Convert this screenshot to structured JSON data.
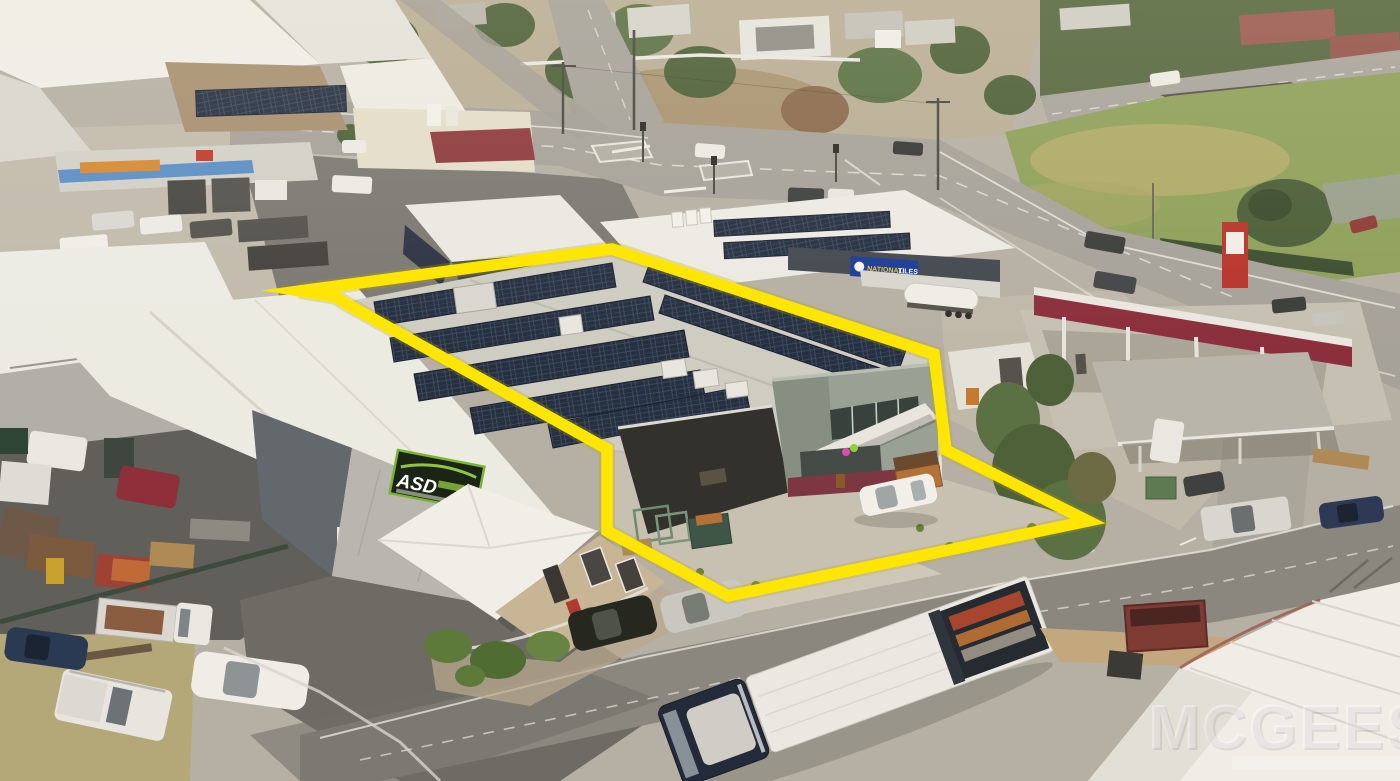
{
  "signs": {
    "asd": {
      "text": "ASD"
    },
    "national_tiles": {
      "word1": "NATIONAL",
      "word2": "TILES"
    }
  },
  "watermark": {
    "text": "MCGEES"
  },
  "annotation": {
    "boundary_color": "#FFE600"
  },
  "palette": {
    "solar_panel": "#27303f",
    "grass_field": "#8fa05a",
    "fuel_canopy_fascia": "#8c2f3d",
    "tiles_sign_blue": "#1c3d96",
    "asd_sign_green": "#8fc63d"
  }
}
